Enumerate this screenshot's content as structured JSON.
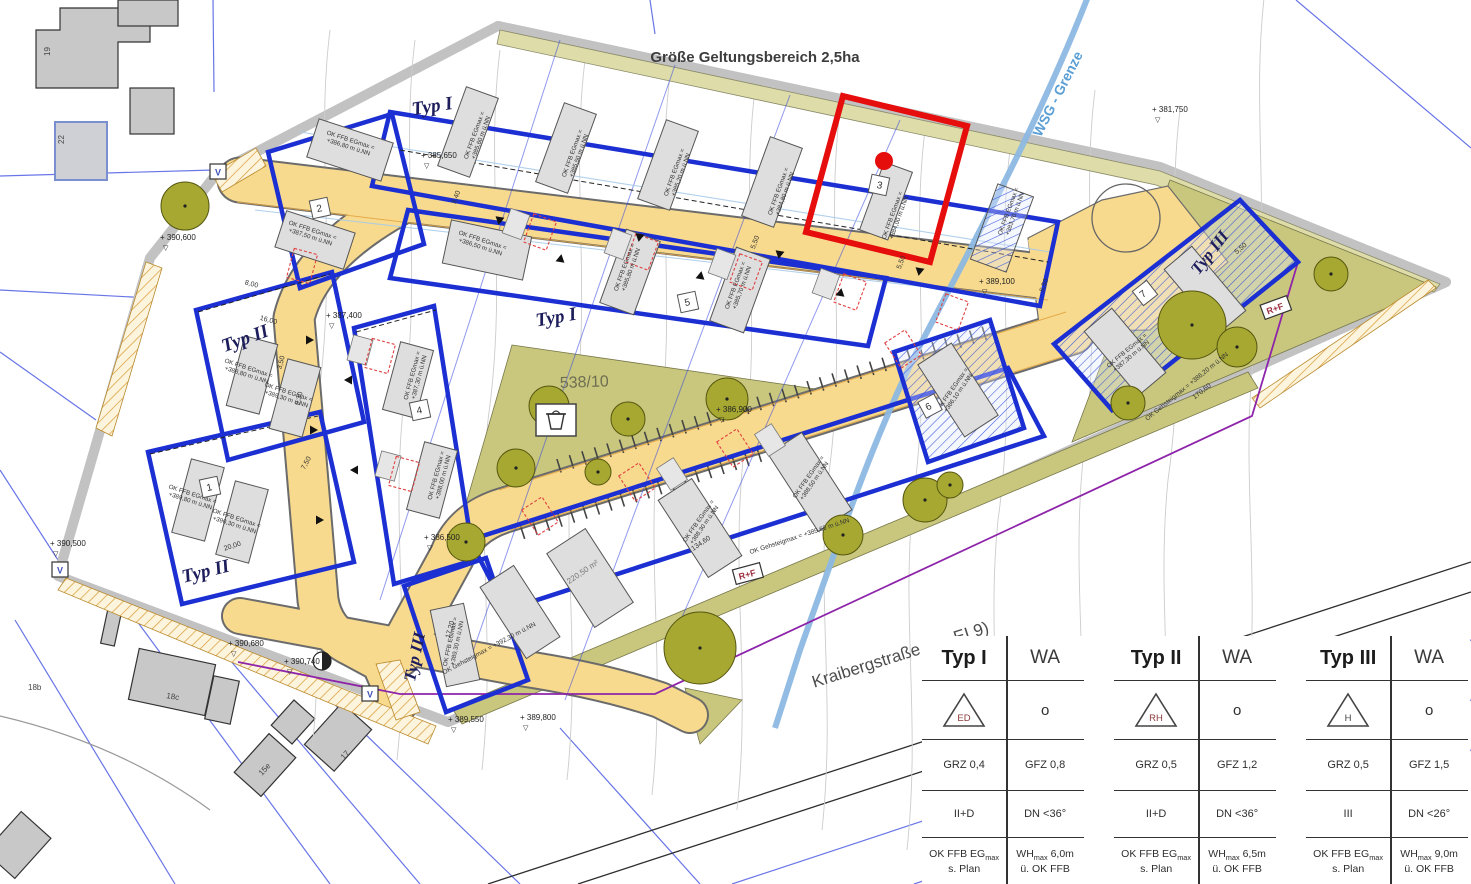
{
  "map": {
    "title": "Größe Geltungsbereich 2,5ha",
    "wsg_label": "WSG - Grenze",
    "street_name": "Kraibergstraße (Kr. EI 9)",
    "parcel_label": "538/10",
    "bldg_label_prefix": "OK FFB EGmax =",
    "zone_labels": [
      {
        "t": "Typ I",
        "x": 433,
        "y": 112,
        "r": -9,
        "s": 19
      },
      {
        "t": "Typ I",
        "x": 557,
        "y": 323,
        "r": -10,
        "s": 19
      },
      {
        "t": "Typ II",
        "x": 247,
        "y": 344,
        "r": -20,
        "s": 19
      },
      {
        "t": "Typ II",
        "x": 207,
        "y": 577,
        "r": -14,
        "s": 19
      },
      {
        "t": "Typ III",
        "x": 420,
        "y": 658,
        "r": -78,
        "s": 17
      },
      {
        "t": "Typ III",
        "x": 1214,
        "y": 256,
        "r": -52,
        "s": 17
      }
    ],
    "plot_numbers": [
      {
        "n": "1",
        "x": 210,
        "y": 487,
        "r": -12
      },
      {
        "n": "2",
        "x": 320,
        "y": 208,
        "r": -12
      },
      {
        "n": "3",
        "x": 879,
        "y": 185,
        "r": 12
      },
      {
        "n": "4",
        "x": 420,
        "y": 410,
        "r": -12
      },
      {
        "n": "5",
        "x": 688,
        "y": 302,
        "r": -12
      },
      {
        "n": "6",
        "x": 930,
        "y": 406,
        "r": -28
      },
      {
        "n": "7",
        "x": 1145,
        "y": 293,
        "r": -38
      }
    ],
    "badges": [
      {
        "t": "V",
        "x": 218,
        "y": 172,
        "r": 0,
        "c": "#3f51b5"
      },
      {
        "t": "V",
        "x": 60,
        "y": 570,
        "r": 0,
        "c": "#3f51b5"
      },
      {
        "t": "V",
        "x": 370,
        "y": 694,
        "r": 0,
        "c": "#3f51b5"
      },
      {
        "t": "R+F",
        "x": 748,
        "y": 574,
        "r": -15,
        "c": "#9c2f3f"
      },
      {
        "t": "R+F",
        "x": 1276,
        "y": 308,
        "r": -20,
        "c": "#9c2f3f"
      }
    ],
    "elevations": [
      {
        "t": "+ 385,650",
        "x": 421,
        "y": 158
      },
      {
        "t": "+ 387,400",
        "x": 326,
        "y": 318
      },
      {
        "t": "+ 389,100",
        "x": 979,
        "y": 284
      },
      {
        "t": "+ 381,750",
        "x": 1152,
        "y": 112
      },
      {
        "t": "+ 390,600",
        "x": 160,
        "y": 240
      },
      {
        "t": "+ 390,500",
        "x": 50,
        "y": 546
      },
      {
        "t": "+ 390,680",
        "x": 228,
        "y": 646
      },
      {
        "t": "+ 390,740",
        "x": 284,
        "y": 664
      },
      {
        "t": "+ 389,550",
        "x": 448,
        "y": 722
      },
      {
        "t": "+ 389,800",
        "x": 520,
        "y": 720
      },
      {
        "t": "+ 386,900",
        "x": 716,
        "y": 412
      },
      {
        "t": "+ 386,500",
        "x": 424,
        "y": 540
      }
    ],
    "dimensions": [
      {
        "t": "5,50",
        "x": 757,
        "y": 243,
        "r": -70
      },
      {
        "t": "5,50",
        "x": 903,
        "y": 263,
        "r": -70
      },
      {
        "t": "5,50",
        "x": 1046,
        "y": 286,
        "r": -70
      },
      {
        "t": "5,50",
        "x": 1242,
        "y": 250,
        "r": -40
      },
      {
        "t": "8,00",
        "x": 251,
        "y": 286,
        "r": 15
      },
      {
        "t": "16,00",
        "x": 268,
        "y": 322,
        "r": 15
      },
      {
        "t": "9,30",
        "x": 301,
        "y": 399,
        "r": -75
      },
      {
        "t": "3,50",
        "x": 283,
        "y": 363,
        "r": -75
      },
      {
        "t": "20,00",
        "x": 233,
        "y": 548,
        "r": -18
      },
      {
        "t": "7,50",
        "x": 308,
        "y": 464,
        "r": -62
      },
      {
        "t": "17,20",
        "x": 452,
        "y": 630,
        "r": -75
      },
      {
        "t": "134,60",
        "x": 702,
        "y": 545,
        "r": -34
      },
      {
        "t": "170,60",
        "x": 1203,
        "y": 393,
        "r": -38
      },
      {
        "t": "3,40",
        "x": 458,
        "y": 198,
        "r": -70
      }
    ],
    "building_labels": [
      {
        "x": 476,
        "y": 136,
        "r": -70,
        "v": "+385,60 m ü.NN"
      },
      {
        "x": 574,
        "y": 154,
        "r": -70,
        "v": "+385,50 m ü.NN"
      },
      {
        "x": 676,
        "y": 173,
        "r": -70,
        "v": "+385,20 m ü.NN"
      },
      {
        "x": 780,
        "y": 192,
        "r": -70,
        "v": "+384,80 m ü.NN"
      },
      {
        "x": 894,
        "y": 216,
        "r": -70,
        "v": "+384,00 m ü.NN"
      },
      {
        "x": 1010,
        "y": 212,
        "r": -70,
        "v": "+383,70 m ü.NN"
      },
      {
        "x": 350,
        "y": 142,
        "r": 18,
        "v": "+386,80 m ü.NN"
      },
      {
        "x": 312,
        "y": 232,
        "r": 18,
        "v": "+387,50 m ü.NN"
      },
      {
        "x": 248,
        "y": 370,
        "r": 18,
        "v": "+388,80 m ü.NN"
      },
      {
        "x": 288,
        "y": 394,
        "r": 18,
        "v": "+389,30 m ü.NN"
      },
      {
        "x": 192,
        "y": 496,
        "r": 18,
        "v": "+389,80 m ü.NN"
      },
      {
        "x": 236,
        "y": 520,
        "r": 18,
        "v": "+390,30 m ü.NN"
      },
      {
        "x": 482,
        "y": 242,
        "r": 18,
        "v": "+386,50 m ü.NN"
      },
      {
        "x": 626,
        "y": 268,
        "r": -70,
        "v": "+385,80 m ü.NN"
      },
      {
        "x": 737,
        "y": 286,
        "r": -70,
        "v": "+385,70 m ü.NN"
      },
      {
        "x": 414,
        "y": 376,
        "r": -75,
        "v": "+387,30 m ü.NN"
      },
      {
        "x": 438,
        "y": 476,
        "r": -75,
        "v": "+388,00 m ü.NN"
      },
      {
        "x": 452,
        "y": 642,
        "r": -78,
        "v": "+389,30 m ü.NN"
      },
      {
        "x": 700,
        "y": 522,
        "r": -55,
        "v": "+388,30 m ü.NN"
      },
      {
        "x": 810,
        "y": 478,
        "r": -55,
        "v": "+388,50 m ü.NN"
      },
      {
        "x": 954,
        "y": 390,
        "r": -55,
        "v": "+386,10 m ü.NN"
      },
      {
        "x": 1128,
        "y": 352,
        "r": -40,
        "v": "+387,30 m ü.NN"
      }
    ],
    "area_labels": [
      {
        "t": "220,50 m²",
        "x": 584,
        "y": 574,
        "r": -34
      }
    ],
    "street_level_labels": [
      {
        "t": "OK Gehsteigmax = +389,60 m ü.NN",
        "x": 800,
        "y": 538,
        "r": -18
      },
      {
        "t": "OK Gehsteigmax = +392,30 m ü.NN",
        "x": 490,
        "y": 650,
        "r": -28
      },
      {
        "t": "OK Gehsteigmax = +386,20 m ü.NN",
        "x": 1188,
        "y": 388,
        "r": -39
      }
    ],
    "house_numbers": [
      {
        "t": "19",
        "x": 50,
        "y": 56,
        "r": -90
      },
      {
        "t": "22",
        "x": 64,
        "y": 144,
        "r": -90
      },
      {
        "t": "18b",
        "x": 28,
        "y": 690,
        "r": 0
      },
      {
        "t": "18c",
        "x": 166,
        "y": 698,
        "r": 10
      },
      {
        "t": "15e",
        "x": 262,
        "y": 776,
        "r": -48
      },
      {
        "t": "17",
        "x": 344,
        "y": 760,
        "r": -48
      }
    ]
  },
  "legend": {
    "tables": [
      {
        "type": "Typ I",
        "use": "WA",
        "letter": "ED",
        "letter_color": "#8a3a3a",
        "circle": "o",
        "grz": "GRZ 0,4",
        "gfz": "GFZ 0,8",
        "storeys": "II+D",
        "roof": "DN <36°",
        "ffb": [
          "OK FFB EGmax",
          "s. Plan"
        ],
        "wh": [
          "WHmax 6,0m",
          "ü. OK FFB"
        ]
      },
      {
        "type": "Typ II",
        "use": "WA",
        "letter": "RH",
        "letter_color": "#8a3a3a",
        "circle": "o",
        "grz": "GRZ 0,5",
        "gfz": "GFZ 1,2",
        "storeys": "II+D",
        "roof": "DN <36°",
        "ffb": [
          "OK FFB EGmax",
          "s. Plan"
        ],
        "wh": [
          "WHmax 6,5m",
          "ü. OK FFB"
        ]
      },
      {
        "type": "Typ III",
        "use": "WA",
        "letter": "H",
        "letter_color": "#444444",
        "circle": "o",
        "grz": "GRZ 0,5",
        "gfz": "GFZ 1,5",
        "storeys": "III",
        "roof": "DN <26°",
        "ffb": [
          "OK FFB EGmax",
          "s. Plan"
        ],
        "wh": [
          "WHmax 9,0m",
          "ü. OK FFB"
        ]
      }
    ]
  },
  "colors": {
    "envelope_blue": "#1B2FD2",
    "highlight_red": "#E60D0D",
    "street_yellow": "#F8DA8E",
    "green_area": "#C9C77D",
    "khaki_strip": "#DEDCA8",
    "wsg_blue": "#8CB8E2",
    "purple_line": "#8E24AA",
    "zone_label_navy": "#1d1d5c"
  }
}
